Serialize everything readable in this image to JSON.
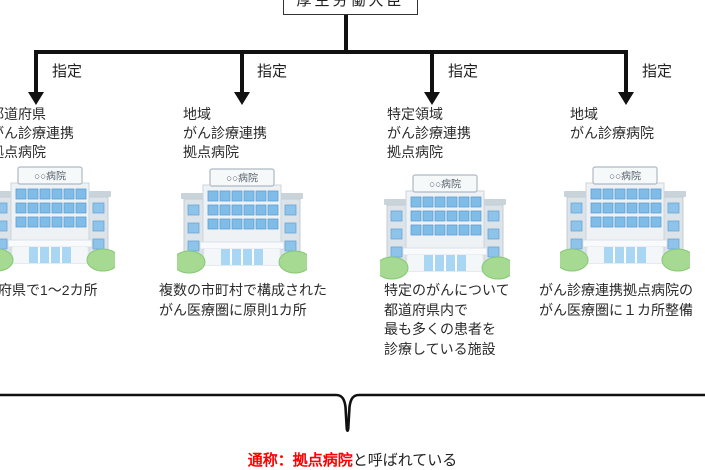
{
  "root": {
    "label": "厚生労働大臣"
  },
  "designation_label": "指定",
  "hospital_sign": "○○病院",
  "columns": [
    {
      "title_lines": [
        "都道府県",
        "がん診療連携",
        "拠点病院"
      ],
      "description_lines": [
        "都道府県で1～2カ所"
      ]
    },
    {
      "title_lines": [
        "地域",
        "がん診療連携",
        "拠点病院"
      ],
      "description_lines": [
        "複数の市町村で構成された",
        "がん医療圏に原則1カ所"
      ]
    },
    {
      "title_lines": [
        "特定領域",
        "がん診療連携",
        "拠点病院"
      ],
      "description_lines": [
        "特定のがんについて",
        "都道府県内で",
        "最も多くの患者を",
        "診療している施設"
      ]
    },
    {
      "title_lines": [
        "地域",
        "がん診療病院"
      ],
      "description_lines": [
        "がん診療連携拠点病院の",
        "がん医療圏に１カ所整備"
      ]
    }
  ],
  "footer": {
    "highlight_text": "通称：拠点病院",
    "plain_text": "と呼ばれている"
  },
  "colors": {
    "line_black": "#111111",
    "text_black": "#2b2b2b",
    "footer_red": "#ff0000",
    "window_blue": "#7fbce8",
    "door_blue": "#a9d6f2",
    "bush_green": "#a6da92",
    "building_gray": "#eef2f5",
    "wing_gray": "#dde4e9",
    "sign_bg": "#f6f9fa"
  }
}
